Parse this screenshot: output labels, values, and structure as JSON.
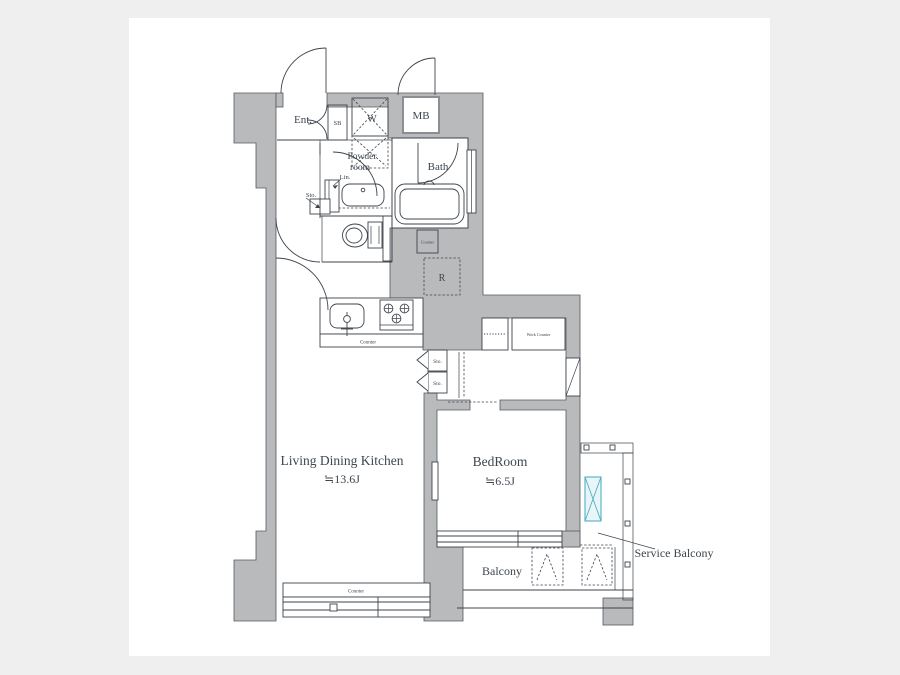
{
  "colors": {
    "page_bg": "#efefef",
    "paper": "#ffffff",
    "wall_fill": "#b9babc",
    "wall_stroke": "#55595d",
    "wet_fill": "#d9e4ee",
    "beige_fill": "#ece3cb",
    "line": "#3d444b",
    "text": "#3e464e",
    "cyan": "#4fb0c5",
    "cyan_fill": "#e9f5f8"
  },
  "rooms": {
    "entrance": "Ent.",
    "shoe_box": "SB",
    "washer": "W",
    "meter_box": "MB",
    "powder_line1": "Powder",
    "powder_line2": "room",
    "bath": "Bath",
    "linen": "Lin.",
    "storage_hall": "Sto.",
    "storage_bed1": "Sto.",
    "storage_bed2": "Sto.",
    "refrigerator": "R",
    "ldk_name": "Living Dining Kitchen",
    "ldk_size": "≒13.6J",
    "bedroom_name": "BedRoom",
    "bedroom_size": "≒6.5J",
    "balcony": "Balcony",
    "service_balcony": "Service Balcony"
  },
  "fixtures": {
    "counter_wall_box": "Counter",
    "counter_kitchen": "Counter",
    "counter_window": "Counter",
    "work_counter": "Work Counter"
  }
}
